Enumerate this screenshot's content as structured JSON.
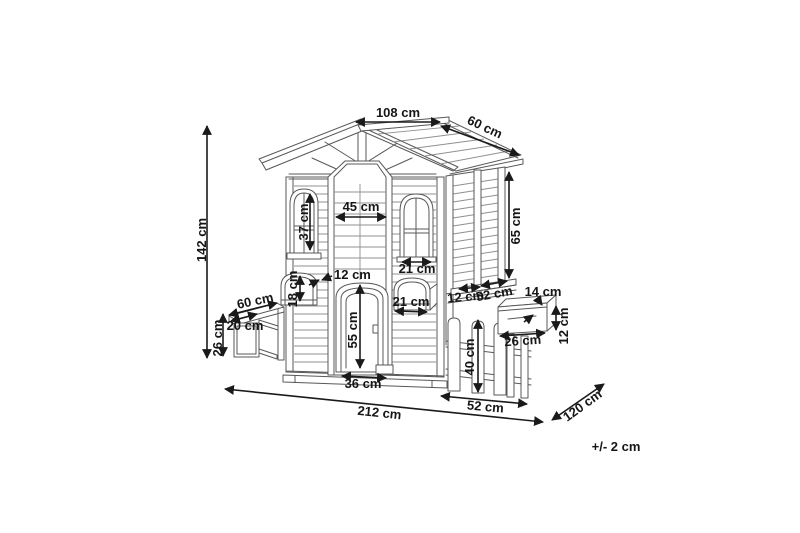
{
  "diagram": {
    "subject": "playhouse dimension drawing",
    "unit": "cm",
    "background": "#ffffff",
    "line_color": "#585858",
    "dimension_color": "#161616",
    "dims": {
      "roof_ridge": "108 cm",
      "roof_slope": "60 cm",
      "total_height": "142 cm",
      "inner_width": "45 cm",
      "window_left_height": "37 cm",
      "window_right_width": "21 cm",
      "door_frame_width": "12 cm",
      "flowerbox_left_height": "18 cm",
      "bench_length": "60 cm",
      "bench_depth": "20 cm",
      "bench_height": "26 cm",
      "door_height": "55 cm",
      "door_width": "36 cm",
      "flowerbox_right_width": "21 cm",
      "side_rail_height": "12 cm",
      "side_rail_length": "52 cm",
      "side_wall_height": "65 cm",
      "mailbox_depth": "14 cm",
      "mailbox_height": "12 cm",
      "mailbox_width": "26 cm",
      "fence_height": "40 cm",
      "fence_length": "52 cm",
      "total_width": "212 cm",
      "total_depth": "120 cm",
      "tolerance": "+/- 2 cm"
    }
  }
}
